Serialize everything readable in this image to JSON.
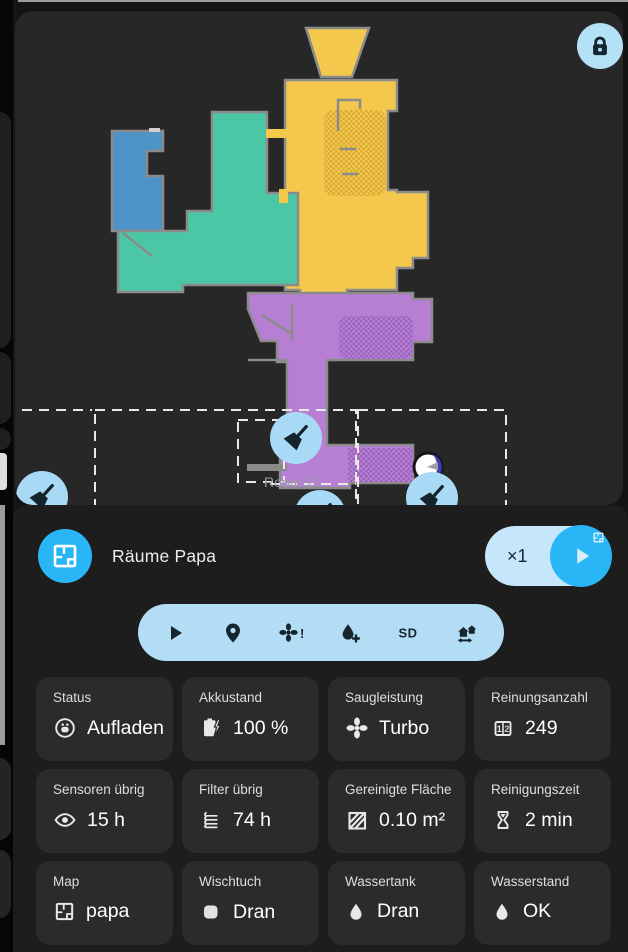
{
  "colors": {
    "accent": "#29b6f6",
    "pill-blue": "#c6e7fb",
    "bar-blue": "#b3ddf5",
    "btn-blue": "#a9daf5",
    "panel-bg": "#1d1d1d",
    "card-bg": "#2b2b2b",
    "map-bg": "#272727",
    "page-bg": "#141414",
    "left-strip": "#060606",
    "room-yellow": "#f3c84d",
    "room-teal": "#4cc7a5",
    "room-blue": "#4e93c8",
    "room-purple": "#b67fd3",
    "wall-gray": "#8b8b8b",
    "icon-dark": "#16262e",
    "zone-dash": "#e8e8e8"
  },
  "map": {
    "room_label": "Room 17",
    "rooms": [
      "yellow-room",
      "teal-room",
      "blue-room",
      "purple-room"
    ],
    "icons": [
      "lock-icon",
      "broom-icon",
      "robot-marker-icon"
    ]
  },
  "header": {
    "title": "Räume Papa",
    "iterations": "×1",
    "icons": [
      "floorplan-icon",
      "play-icon"
    ]
  },
  "action_bar": {
    "icons": [
      "play-icon",
      "locate-pin-icon",
      "fan-alert-icon",
      "water-plus-icon",
      "sd-card-icon",
      "map-transfer-icon"
    ]
  },
  "cards": [
    {
      "label": "Status",
      "value": "Aufladen",
      "icon": "robot-vacuum-icon"
    },
    {
      "label": "Akkustand",
      "value": "100 %",
      "icon": "battery-charging-icon"
    },
    {
      "label": "Saugleistung",
      "value": "Turbo",
      "icon": "fan-icon"
    },
    {
      "label": "Reinungsanzahl",
      "value": "249",
      "icon": "counter-icon"
    },
    {
      "label": "Sensoren übrig",
      "value": "15 h",
      "icon": "eye-icon"
    },
    {
      "label": "Filter übrig",
      "value": "74 h",
      "icon": "filter-icon"
    },
    {
      "label": "Gereinigte Fläche",
      "value": "0.10 m²",
      "icon": "striped-area-icon"
    },
    {
      "label": "Reinigungszeit",
      "value": "2 min",
      "icon": "hourglass-icon"
    },
    {
      "label": "Map",
      "value": "papa",
      "icon": "floorplan-icon"
    },
    {
      "label": "Wischtuch",
      "value": "Dran",
      "icon": "cloth-icon"
    },
    {
      "label": "Wassertank",
      "value": "Dran",
      "icon": "water-drop-icon"
    },
    {
      "label": "Wasserstand",
      "value": "OK",
      "icon": "water-drop-icon"
    }
  ]
}
